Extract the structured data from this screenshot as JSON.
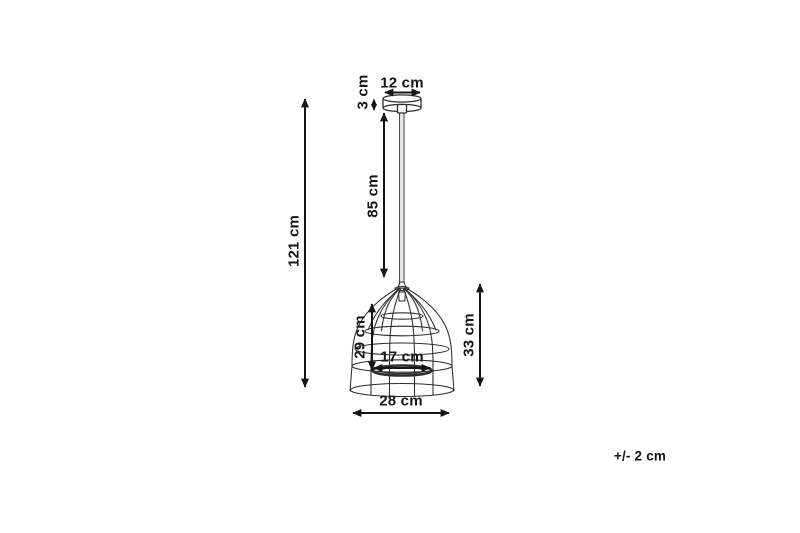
{
  "diagram": {
    "name": "Pendant lamp dimension diagram",
    "labels": {
      "total_height": "121 cm",
      "cord_length": "85 cm",
      "canopy_width": "12 cm",
      "canopy_height": "3 cm",
      "shade_inner_height": "29 cm",
      "shade_height": "33 cm",
      "inner_diameter": "17 cm",
      "shade_diameter": "28 cm",
      "tolerance": "+/- 2 cm"
    },
    "colors": {
      "dimension": "#151515",
      "line": "#2e2d2c",
      "cord_fill": "#ececec",
      "background": "#ffffff"
    }
  }
}
